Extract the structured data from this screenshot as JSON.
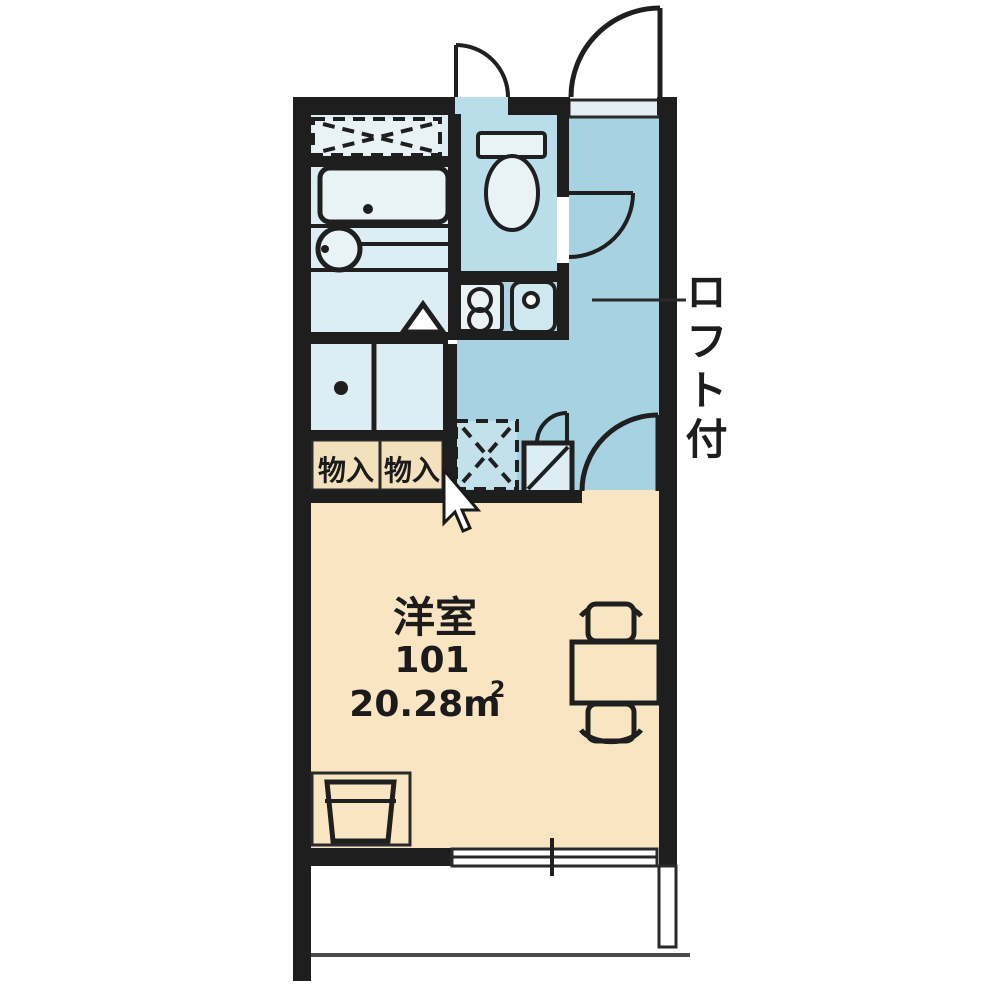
{
  "floorplan": {
    "labels": {
      "room_name": "洋室",
      "room_number": "101",
      "room_area": "20.28m",
      "room_area_sup": "2",
      "storage_left": "物入",
      "storage_right": "物入",
      "loft_note": "ロフト付"
    },
    "colors": {
      "wall": "#1e1e1e",
      "bath_floor": "#dceef3",
      "fixture_light": "#e9f3f6",
      "hall_floor": "#a7d2e2",
      "toilet_floor": "#badee9",
      "counter_blue": "#aed2df",
      "sink_blue": "#cfe7ef",
      "fridge_blue": "#c3e1ea",
      "room_floor": "#fae5c3",
      "storage_floor": "#f3e0bc",
      "step_floor": "#e3eff4",
      "white": "#ffffff",
      "dot": "#1f1f1f"
    }
  }
}
